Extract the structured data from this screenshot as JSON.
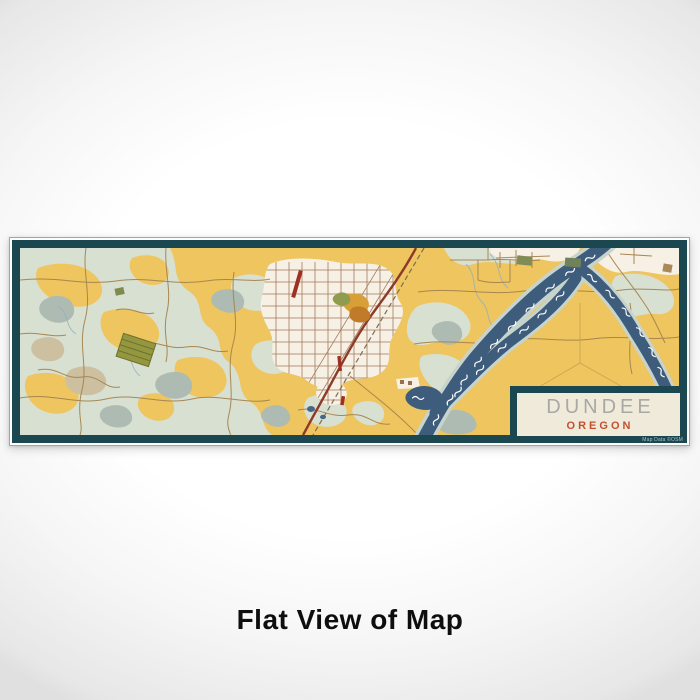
{
  "caption": {
    "text": "Flat View of Map"
  },
  "map": {
    "city": "DUNDEE",
    "state": "OREGON",
    "attribution": "Map Data ©OSM",
    "colors": {
      "frame_teal": "#1B4850",
      "land_yellow": "#EEC55E",
      "terrain_sage": "#D8E0D1",
      "terrain_shade": "#AEBBB2",
      "terrain_tan": "#CDC0A0",
      "urban_cream": "#F6F1E4",
      "water_blue": "#3E5C7C",
      "river_bank": "#C7D4CD",
      "road_brown": "#A5834E",
      "street_brown": "#9B6E4F",
      "highway_red": "#8C3A2A",
      "accent_red": "#9E2F23",
      "vineyard_olive": "#95973F",
      "poi_gold": "#D79F35",
      "title_panel_cream": "#F0EADA",
      "city_text_gray": "#A7A9A4",
      "state_text_rust": "#C2512F"
    }
  }
}
